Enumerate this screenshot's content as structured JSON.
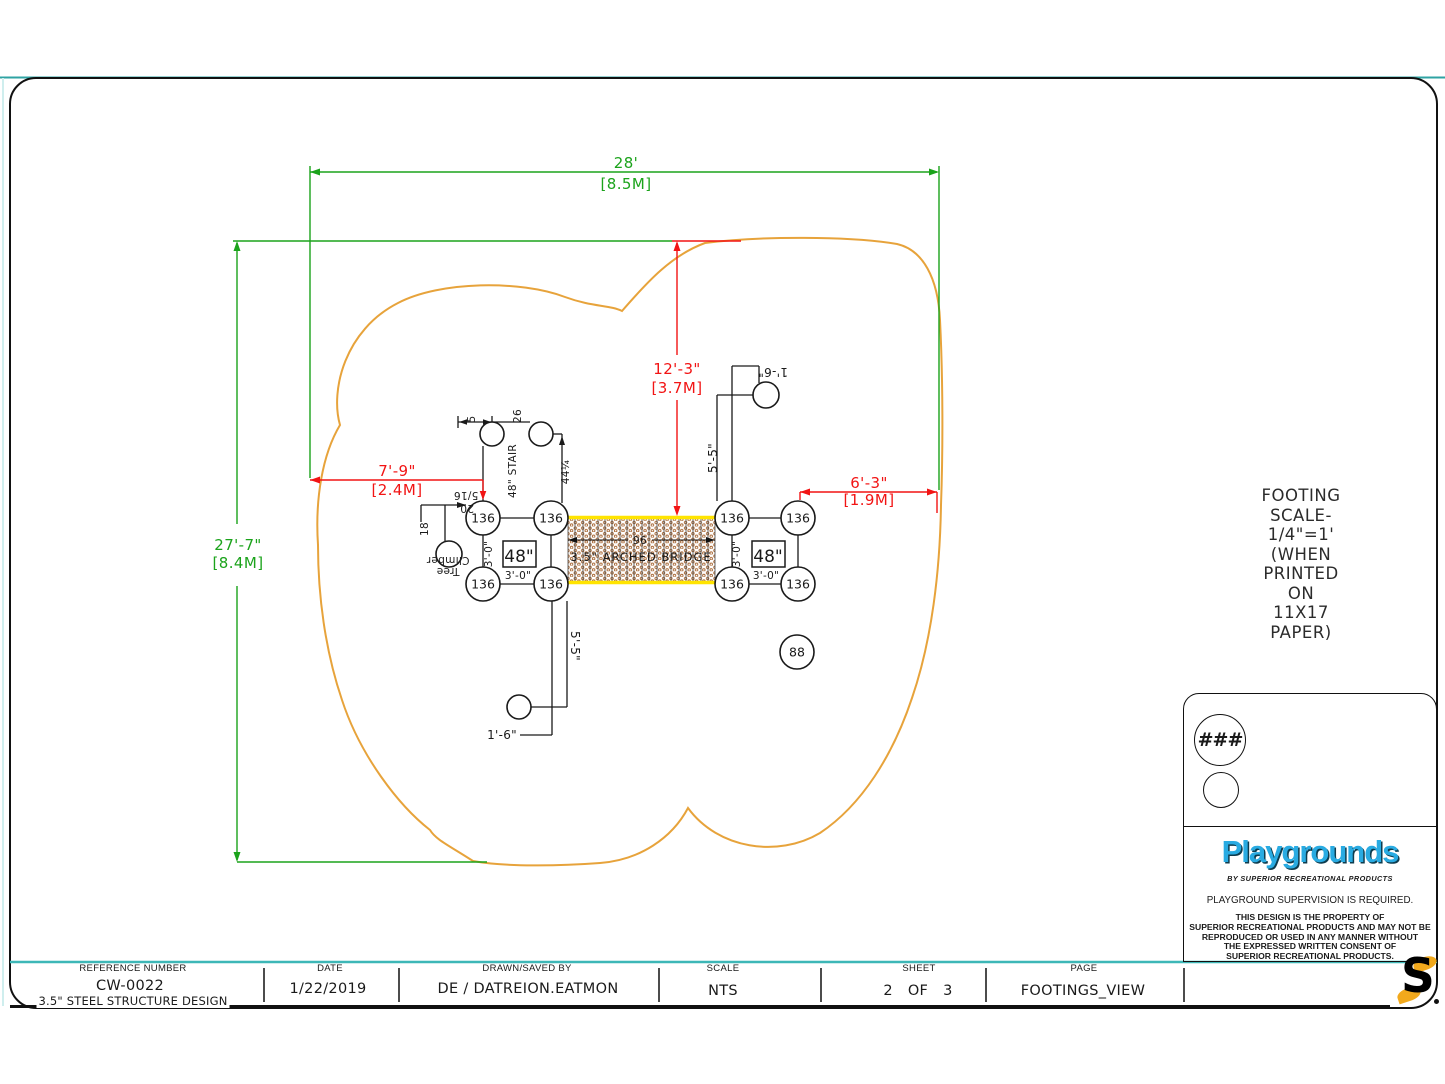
{
  "dims": {
    "width_ft": "28'",
    "width_m": "[8.5M]",
    "height_ft": "27'-7\"",
    "height_m": "[8.4M]",
    "drop_ft": "12'-3\"",
    "drop_m": "[3.7M]",
    "left_ft": "7'-9\"",
    "left_m": "[2.4M]",
    "right_ft": "6'-3\"",
    "right_m": "[1.9M]",
    "stair_label": "48\" STAIR",
    "stair_26": "26",
    "stair_5": "5",
    "stair_44": "44¼",
    "tree_516": "5/16",
    "tree_20": "20",
    "tree_18": "18",
    "tree_line1": "Tree",
    "tree_line2": "Climber",
    "three_zero": "3'-0\"",
    "five_five": "5'-5\"",
    "one_six": "1'-6\"",
    "bridge_96": "96"
  },
  "structure": {
    "bridge_label": "3.5\" ARCHED BRIDGE",
    "deck_label": "48\"",
    "footing_main": "136",
    "footing_alt": "88"
  },
  "note": {
    "lines": [
      "FOOTING",
      "SCALE-",
      "1/4\"=1'",
      "(WHEN",
      "PRINTED",
      "ON",
      "11X17",
      "PAPER)"
    ]
  },
  "title_block": {
    "reference_label": "REFERENCE NUMBER",
    "reference_number": "CW-0022",
    "design_note": "3.5\" STEEL STRUCTURE DESIGN",
    "date_label": "DATE",
    "date": "1/22/2019",
    "drawn_label": "DRAWN/SAVED BY",
    "drawn_by": "DE / DATREION.EATMON",
    "scale_label": "SCALE",
    "scale": "NTS",
    "sheet_label": "SHEET",
    "sheet": "2 OF 3",
    "page_label": "PAGE",
    "page": "FOOTINGS_VIEW"
  },
  "brand": {
    "badge": "###",
    "logo": "Playgrounds",
    "tagline": "BY SUPERIOR RECREATIONAL PRODUCTS",
    "supervision": "PLAYGROUND SUPERVISION IS REQUIRED.",
    "legal": [
      "THIS DESIGN IS THE PROPERTY OF",
      "SUPERIOR RECREATIONAL PRODUCTS AND MAY NOT BE",
      "REPRODUCED OR USED IN ANY MANNER WITHOUT",
      "THE EXPRESSED WRITTEN CONSENT OF",
      "SUPERIOR RECREATIONAL PRODUCTS."
    ],
    "s_mark": "S"
  },
  "colors": {
    "dimension_green": "#1ba31b",
    "dimension_red": "#f21414",
    "use_zone_yellow": "#e7a33b",
    "bridge_yellow": "#ffe400",
    "hatch_brown": "#a5622d",
    "brand_blue": "#29abe2",
    "teal_accent": "#2fa3a3",
    "s_gold": "#f2a91c"
  }
}
